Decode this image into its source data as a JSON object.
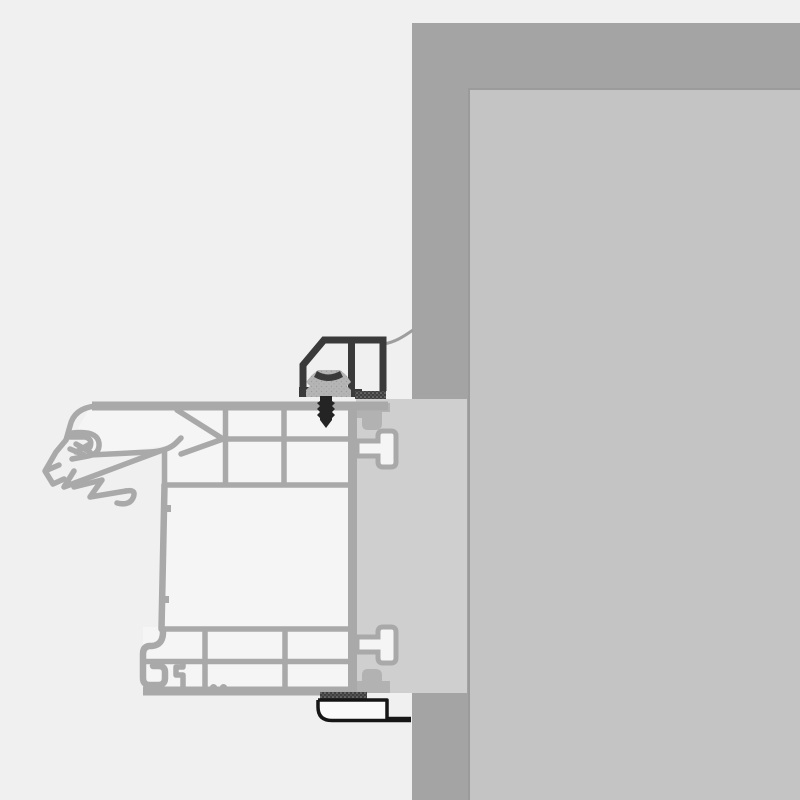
{
  "diagram": {
    "type": "technical-cross-section",
    "subject": "window-frame-to-wall-installation-detail",
    "visible_text": [],
    "colors": {
      "background": "#f0f0f0",
      "wall": "#a4a4a4",
      "wall_inner_panel": "#c4c4c4",
      "panel_border": "#9b9b9b",
      "frame_overlap_fill": "#cfcfcf",
      "profile_stroke": "#a9a9a9",
      "profile_fill": "#f5f5f5",
      "cleat_gray": "#b2b2b2",
      "bracket_dark": "#3a3a3a",
      "clip_gray": "#b5b5b5",
      "screw_dark": "#242424",
      "tape_dark": "#3f3f3f",
      "sill_outline": "#161616",
      "membrane_line": "#9e9e9e"
    },
    "elements": [
      "wall-section",
      "wall-inner-panel",
      "frame-overlap-fill",
      "window-frame-profile",
      "outer-gasket-seal",
      "wall-anchor-top",
      "wall-anchor-bottom",
      "retaining-cleat-top",
      "retaining-cleat-bottom",
      "mounting-bracket-profile",
      "bracket-clip",
      "fixing-screw",
      "sealing-tape-top",
      "sealing-tape-bottom",
      "sealing-membrane-line",
      "sill-end-cap"
    ]
  }
}
